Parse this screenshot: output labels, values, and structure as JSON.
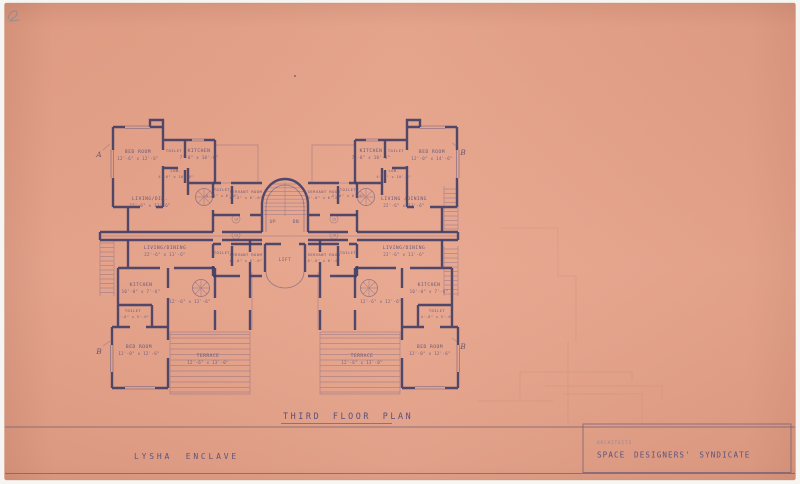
{
  "sheet": {
    "title": "THIRD FLOOR PLAN",
    "project": "LYSHA ENCLAVE",
    "architects_label": "ARCHITECTS",
    "architects_name": "SPACE DESIGNERS' SYNDICATE"
  },
  "colors": {
    "scan_bg": "#f5f6f3",
    "paper": "#e7a38a",
    "paper_edge": "#d28e74",
    "ink": "#3f3d65",
    "ink_light": "#5b5583",
    "text_ink": "#514c7a",
    "faint_ink": "#8b7d96",
    "strip_line": "#6a5b72",
    "ghost": "#9a6a52",
    "pencil": "#8b8890"
  },
  "plan": {
    "core": {
      "up": "UP",
      "dn": "DN",
      "lift": "LIFT"
    },
    "flat_tags": [
      "14",
      "13",
      "15",
      "16"
    ],
    "section_markers": {
      "top_left": "A",
      "top_right": "B",
      "bottom_left": "B",
      "bottom_right": "B"
    },
    "rooms": {
      "tl_bedroom": {
        "name": "BED ROOM",
        "dims": "12'-6\" x 12'-6\""
      },
      "tl_toilet": {
        "name": "TOILET"
      },
      "tl_kitchen": {
        "name": "KITCHEN",
        "dims": "7'-0\" x 10'-6\""
      },
      "tl_lobby": {
        "name": "LOB.",
        "dims": "4'-6\" x 10'-6\""
      },
      "tl_living": {
        "name": "LIVING/DIN.",
        "dims": "22'-6\" x 11'-6\""
      },
      "tl_core_toilet": {
        "name": "TOILET",
        "dims": "4'-0\" x 6'-0\""
      },
      "tl_servant": {
        "name": "SERVANT ROOM",
        "dims": "6'-0\" x 6'-6\""
      },
      "tr_kitchen": {
        "name": "KITCHEN",
        "dims": "7'-0\" x 10'-6\""
      },
      "tr_toilet": {
        "name": "TOILET"
      },
      "tr_bedroom": {
        "name": "BED ROOM",
        "dims": "12'-0\" x 14'-6\""
      },
      "tr_lobby": {
        "name": "LOB.",
        "dims": "4'-6\" x 10'-6\""
      },
      "tr_living": {
        "name": "LIVING /DINING",
        "dims": "22'-6\" x 11'-6\""
      },
      "tr_servant": {
        "name": "SERVANT ROOM",
        "dims": "6'-0\" x 6'-6\""
      },
      "tr_core_toilet": {
        "name": "TOILET",
        "dims": "4'-0\" x 6'-0\""
      },
      "bl_living": {
        "name": "LIVING/DINING",
        "dims": "22'-6\" x 11'-6\""
      },
      "bl_kitchen": {
        "name": "KITCHEN",
        "dims": "10'-0\" x 7'-6\""
      },
      "bl_toilet": {
        "name": "TOILET",
        "dims": "4'-6\" x 5'-0\""
      },
      "bl_room": {
        "dims": "12'-6\" x 12'-6\""
      },
      "bl_bedroom": {
        "name": "BED ROOM",
        "dims": "12'-0\" x 12'-6\""
      },
      "bl_terrace": {
        "name": "TERRACE",
        "dims": "12'-6\" x 13'-0\""
      },
      "bl_servant": {
        "name": "SERVANT ROOM",
        "dims": "6'-0\" x 6'-6\""
      },
      "bl_core_toilet": {
        "name": "TOILET"
      },
      "br_living": {
        "name": "LIVING/DINING",
        "dims": "22'-6\" x 11'-6\""
      },
      "br_kitchen": {
        "name": "KITCHEN",
        "dims": "10'-0\" x 7'-6\""
      },
      "br_toilet": {
        "name": "TOILET",
        "dims": "4'-6\" x 5'-0\""
      },
      "br_room": {
        "dims": "12'-6\" x 12'-6\""
      },
      "br_bedroom": {
        "name": "BED ROOM",
        "dims": "12'-0\" x 12'-6\""
      },
      "br_terrace": {
        "name": "TERRACE",
        "dims": "12'-6\" x 13'-0\""
      },
      "br_servant": {
        "name": "SERVANT ROOM",
        "dims": "6'-0\" x 6'-6\""
      },
      "br_core_toilet": {
        "name": "TOILET"
      }
    }
  }
}
